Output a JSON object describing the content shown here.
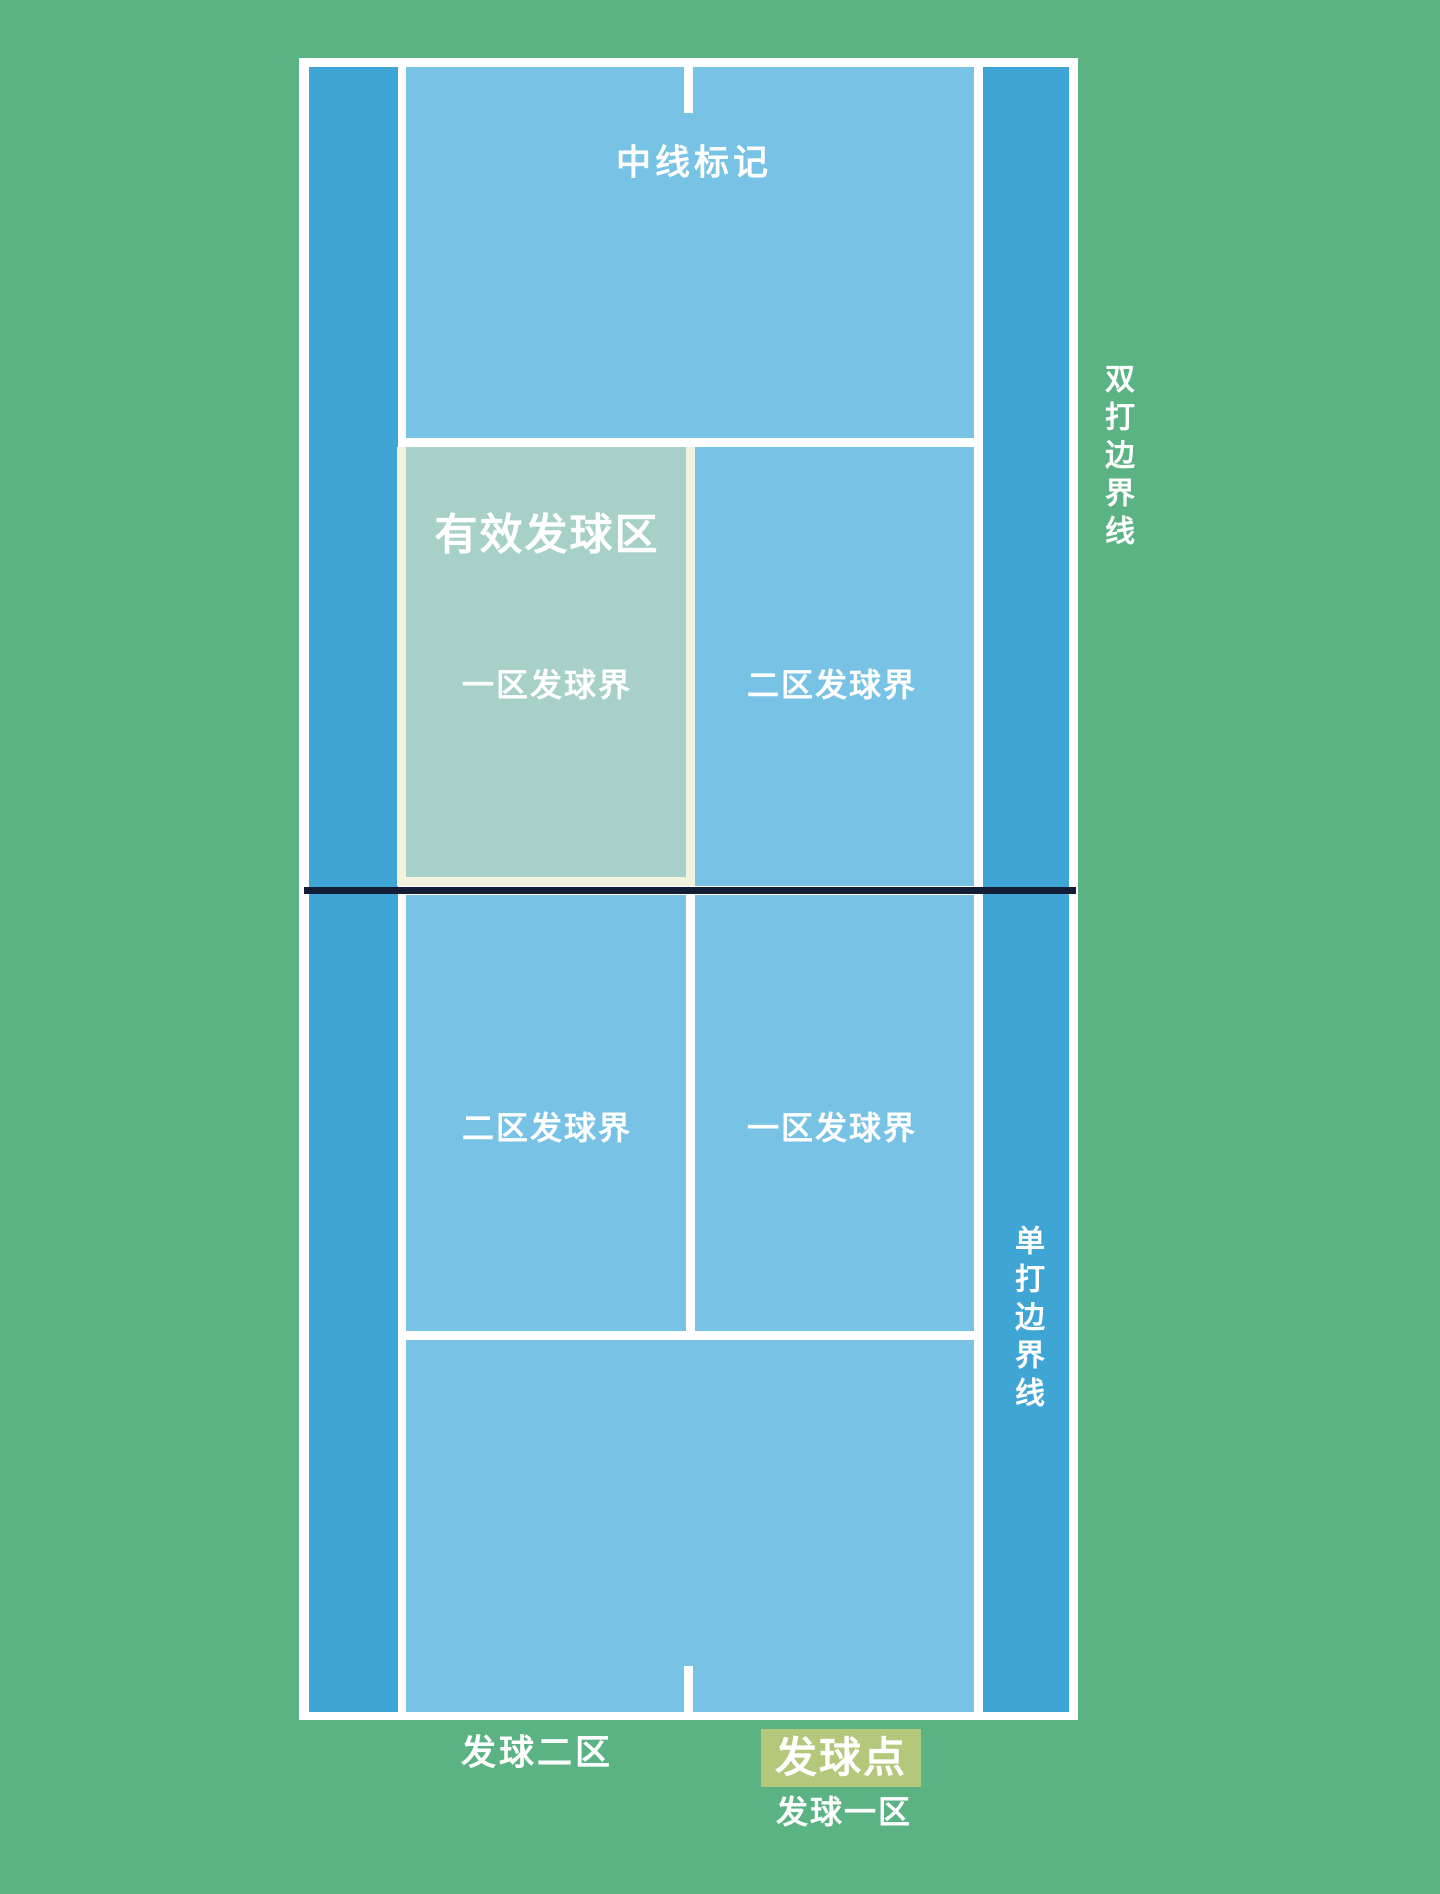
{
  "diagram": {
    "type": "tennis-court-service-areas",
    "labels": {
      "center_mark": "中线标记",
      "valid_service_area": "有效发球区",
      "upper_left_box": "一区发球界",
      "upper_right_box": "二区发球界",
      "lower_left_box": "二区发球界",
      "lower_right_box": "一区发球界",
      "doubles_sideline": "双打边界线",
      "singles_sideline": "单打边界线",
      "service_zone_2": "发球二区",
      "service_point": "发球点",
      "service_zone_1": "发球一区"
    },
    "colors": {
      "background-green": "#5bb384",
      "court-blue": "#77c2e5",
      "alley-blue": "#3fa5d5",
      "highlight-teal": "#a7d0c9",
      "highlight-cream": "#f1f3df",
      "line-white": "#ffffff",
      "net-navy": "#111e36",
      "service-point-olive": "#b4c87c",
      "label-white": "#ffffff"
    }
  }
}
